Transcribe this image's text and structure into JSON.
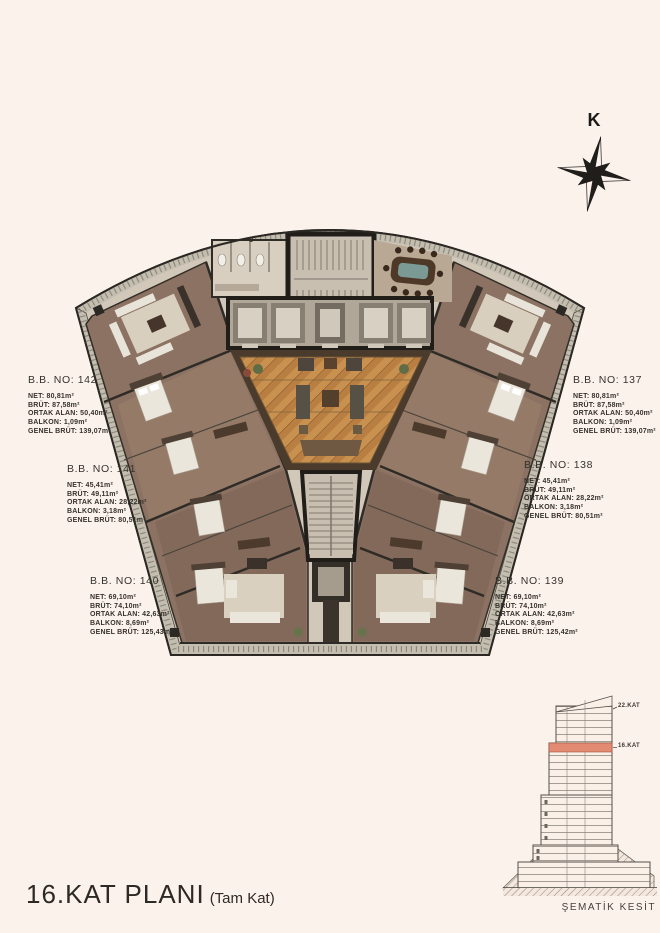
{
  "page": {
    "background": "#fcf2ec",
    "title": "16.KAT PLANI",
    "title_suffix": "(Tam Kat)"
  },
  "compass": {
    "north_label": "K"
  },
  "plan": {
    "room_label": "D"
  },
  "units": [
    {
      "no": "142",
      "label": "B.B. NO: 142",
      "details": [
        "NET: 80,81m²",
        "BRÜT: 87,58m²",
        "ORTAK ALAN: 50,40m²",
        "BALKON: 1,09m²",
        "GENEL BRÜT: 139,07m²"
      ]
    },
    {
      "no": "141",
      "label": "B.B. NO: 141",
      "details": [
        "NET: 45,41m²",
        "BRÜT: 49,11m²",
        "ORTAK ALAN: 28,22m²",
        "BALKON: 3,18m²",
        "GENEL BRÜT: 80,51m²"
      ]
    },
    {
      "no": "140",
      "label": "B.B. NO: 140",
      "details": [
        "NET: 69,10m²",
        "BRÜT: 74,10m²",
        "ORTAK ALAN: 42,63m²",
        "BALKON: 8,69m²",
        "GENEL BRÜT: 125,43m²"
      ]
    },
    {
      "no": "137",
      "label": "B.B. NO: 137",
      "details": [
        "NET: 80,81m²",
        "BRÜT: 87,58m²",
        "ORTAK ALAN: 50,40m²",
        "BALKON: 1,09m²",
        "GENEL BRÜT: 139,07m²"
      ]
    },
    {
      "no": "138",
      "label": "B.B. NO: 138",
      "details": [
        "NET: 45,41m²",
        "BRÜT: 49,11m²",
        "ORTAK ALAN: 28,22m²",
        "BALKON: 3,18m²",
        "GENEL BRÜT: 80,51m²"
      ]
    },
    {
      "no": "139",
      "label": "B.B. NO: 139",
      "details": [
        "NET: 69,10m²",
        "BRÜT: 74,10m²",
        "ORTAK ALAN: 42,63m²",
        "BALKON: 8,69m²",
        "GENEL BRÜT: 125,42m²"
      ]
    }
  ],
  "section": {
    "caption": "ŞEMATİK KESİT",
    "floor_labels": [
      "22.KAT",
      "16.KAT"
    ],
    "highlight_color": "#e28b72"
  },
  "colors": {
    "background": "#fcf2ec",
    "wall": "#211e1a",
    "parquet": "#c9914f",
    "wood": "#8b7262",
    "marble": "#d2c8b9",
    "balcony": "#c4beb0",
    "highlight": "#e28b72"
  }
}
